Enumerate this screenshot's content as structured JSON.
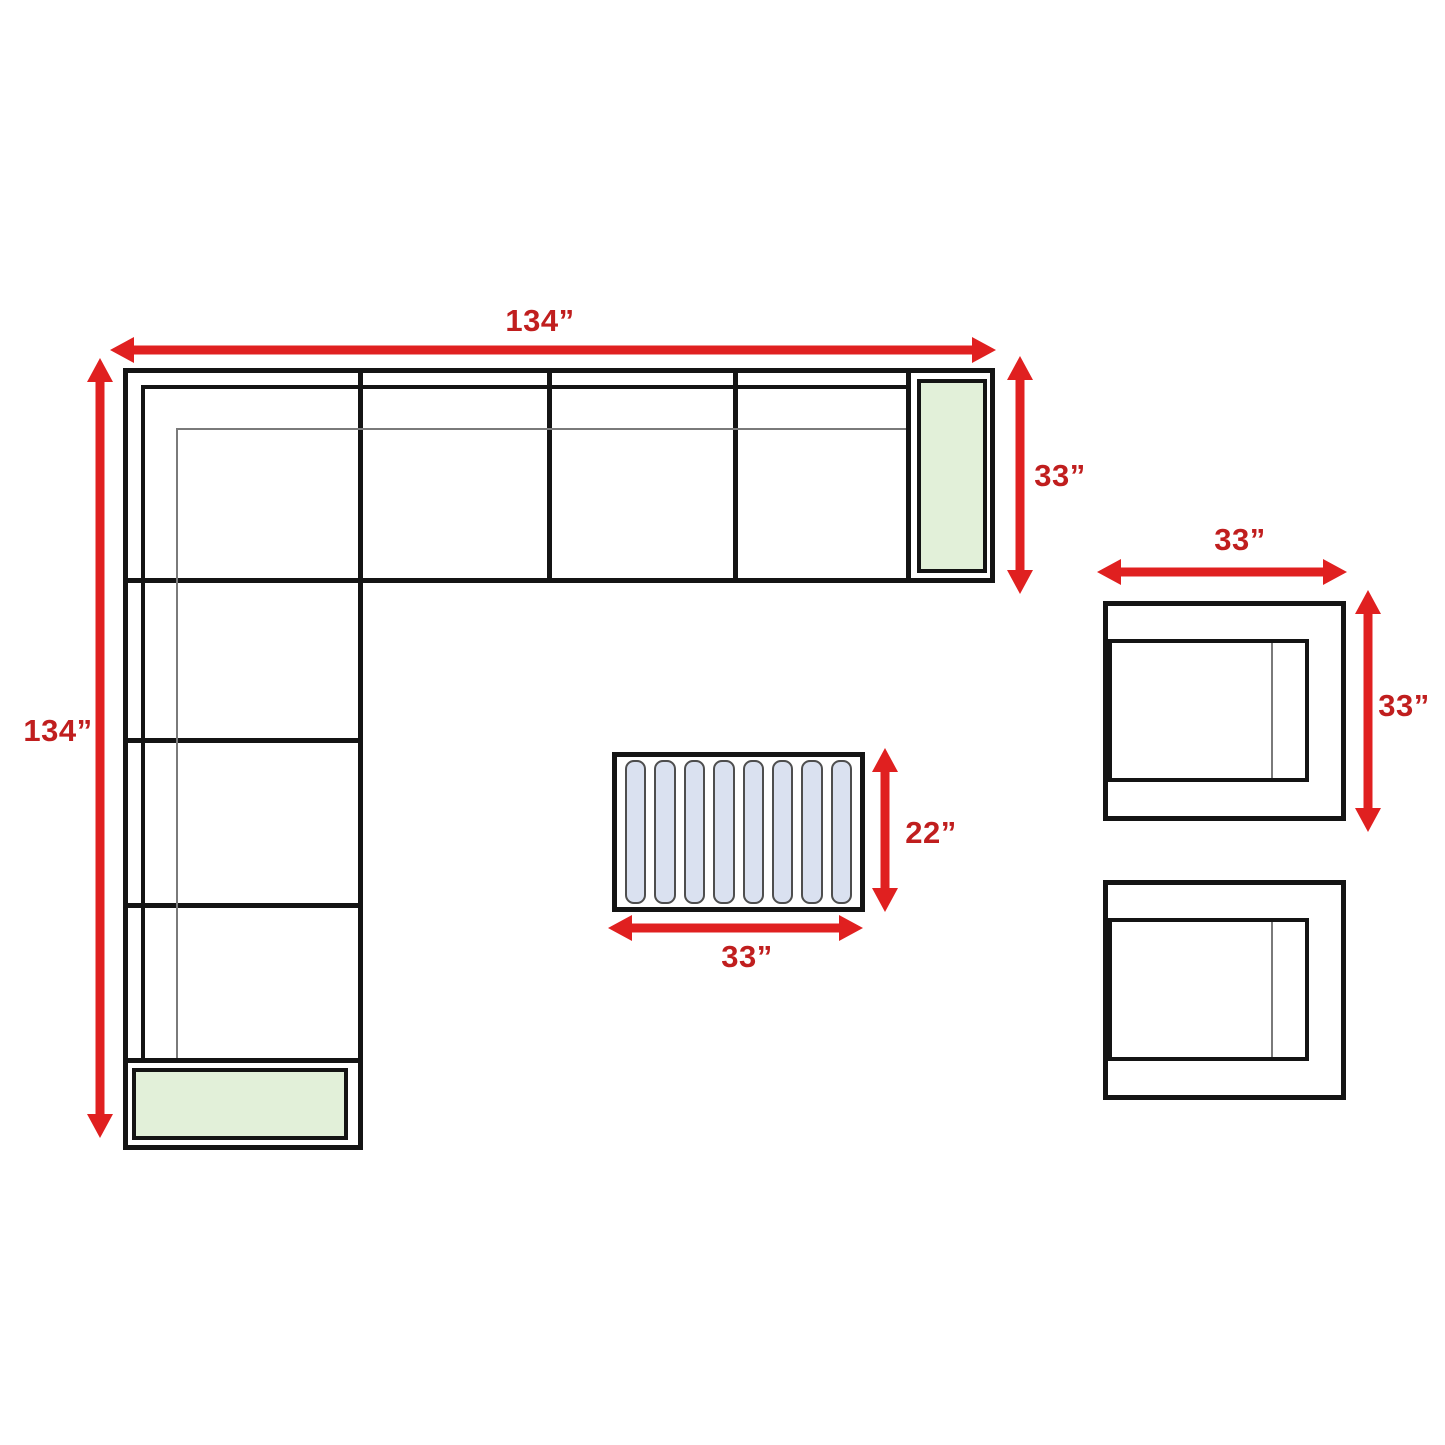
{
  "colors": {
    "arrow_red": "#e02020",
    "label_red": "#c01e1e",
    "outline_black": "#141414",
    "cushion_green": "#e2f0d9",
    "slat_blue": "#dae1f0"
  },
  "sectional": {
    "width_label": "134”",
    "depth_label": "134”",
    "corner_depth_label": "33”"
  },
  "armchair": {
    "width_label": "33”",
    "depth_label": "33”"
  },
  "coffee_table": {
    "width_label": "33”",
    "depth_label": "22”",
    "slat_count": 8
  }
}
